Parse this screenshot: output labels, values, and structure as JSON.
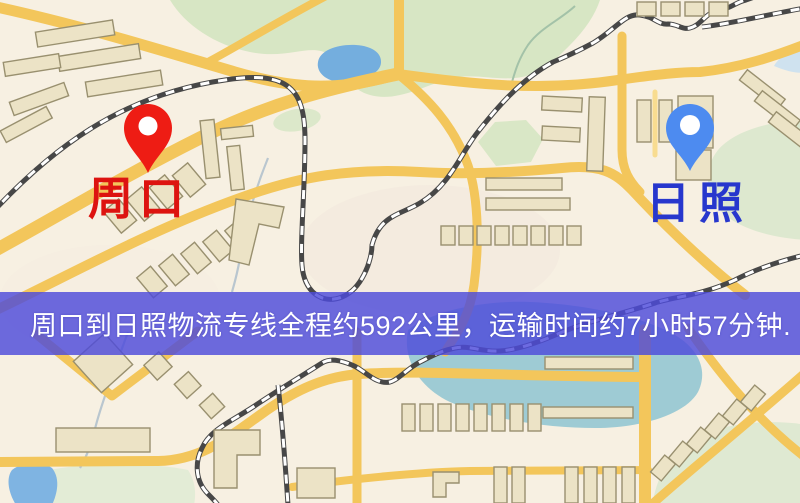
{
  "window": {
    "width": 800,
    "height": 503
  },
  "map": {
    "type": "stylized-city-road-map",
    "colors": {
      "background": "#f7f0e2",
      "road": "#f3c65b",
      "building_fill": "#ece3c6",
      "building_stroke": "#99906f",
      "park": "#d7e6c4",
      "water": "#74aede",
      "rail_dark": "#474747",
      "rail_light": "#ffffff"
    }
  },
  "markers": {
    "origin": {
      "label": "周口",
      "pin_color": "#ee1c14",
      "label_color": "#dd1310"
    },
    "destination": {
      "label": "日照",
      "pin_color": "#4d8bf0",
      "label_color": "#2737cd"
    }
  },
  "banner": {
    "text": "周口到日照物流专线全程约592公里，运输时间约7小时57分钟.",
    "background": "rgba(77,74,218,0.82)",
    "text_color": "#ffffff",
    "route": {
      "origin": "周口",
      "destination": "日照",
      "distance_km": 592,
      "duration": "7小时57分钟"
    }
  }
}
